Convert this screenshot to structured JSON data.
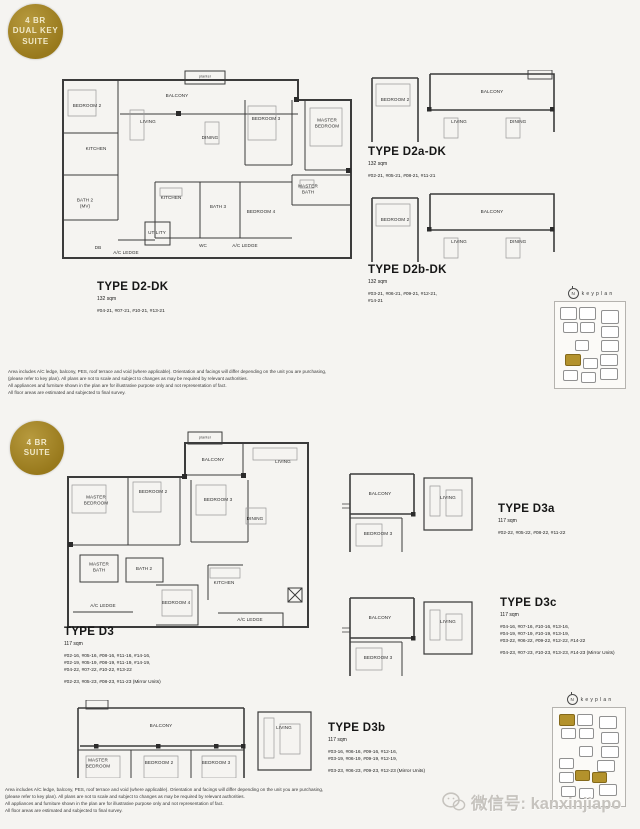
{
  "badges": {
    "dual_key": {
      "line1": "4 BR",
      "line2": "DUAL KEY",
      "line3": "SUITE"
    },
    "suite": {
      "line1": "4 BR",
      "line2": "SUITE"
    }
  },
  "colors": {
    "badge_gold": "#a6871f",
    "keyplan_highlight": "#b3922c",
    "wall": "#3b3b3b"
  },
  "keyplan": {
    "label": "keyplan",
    "north": "N"
  },
  "watermark": {
    "icon": "wechat-icon",
    "text": "微信号: kanxinjiapo"
  },
  "disclaimer": {
    "line1": "Area includes A/C ledge, balcony, PES, roof terrace and void (where applicable). Orientation and facings will differ depending on the unit you are purchasing,",
    "line2": "(please refer to key plan). All plans are not to scale and subject to changes as may be required by relevant authorities.",
    "line3": "All appliances and furniture shown in the plan are for illustrative purpose only and not representation of fact.",
    "line4": "All floor areas are estimated and subjected to final survey."
  },
  "plans": {
    "d2dk": {
      "title": "TYPE D2-DK",
      "area": "132 sqm",
      "units": [
        "#04-21, #07-21, #10-21, #13-21"
      ],
      "rooms": {
        "planter": "planter",
        "balcony": "BALCONY",
        "bedroom2": "BEDROOM 2",
        "living": "LIVING",
        "dining": "DINING",
        "bedroom3": "BEDROOM 3",
        "master_bedroom": "MASTER BEDROOM",
        "kitchen1": "KITCHEN",
        "bath2": "BATH 2 (MV)",
        "kitchen2": "KITCHEN",
        "bath3": "BATH 3",
        "bedroom4": "BEDROOM 4",
        "master_bath": "MASTER BATH",
        "utility": "UTILITY",
        "db": "DB",
        "ac_ledge1": "A/C LEDGE",
        "wc": "WC",
        "ac_ledge2": "A/C LEDGE"
      }
    },
    "d2adk": {
      "title": "TYPE D2a-DK",
      "area": "132 sqm",
      "units": [
        "#02-21, #05-21, #08-21, #11-21"
      ],
      "rooms": {
        "bedroom2": "BEDROOM 2",
        "balcony": "BALCONY",
        "living": "LIVING",
        "dining": "DINING"
      }
    },
    "d2bdk": {
      "title": "TYPE D2b-DK",
      "area": "132 sqm",
      "units": [
        "#03-21, #06-21, #09-21, #12-21,",
        "#14-21"
      ],
      "rooms": {
        "bedroom2": "BEDROOM 2",
        "balcony": "BALCONY",
        "living": "LIVING",
        "dining": "DINING"
      }
    },
    "d3": {
      "title": "TYPE D3",
      "area": "117 sqm",
      "units": [
        "#02-16, #05-16, #08-16, #11-16, #14-16,",
        "#02-19, #05-19, #08-19, #11-19, #14-19,",
        "#04-22, #07-22, #10-22, #13-22"
      ],
      "mirror": "#02-23, #05-23, #08-23, #11-23  (Mirror Units)",
      "rooms": {
        "planter": "planter",
        "balcony": "BALCONY",
        "living": "LIVING",
        "master_bedroom": "MASTER BEDROOM",
        "bedroom2": "BEDROOM 2",
        "bedroom3": "BEDROOM 3",
        "dining": "DINING",
        "master_bath": "MASTER BATH",
        "bath2": "BATH 2",
        "bedroom4": "BEDROOM 4",
        "kitchen": "KITCHEN",
        "ac_ledge1": "A/C LEDGE",
        "ac_ledge2": "A/C LEDGE"
      }
    },
    "d3a": {
      "title": "TYPE D3a",
      "area": "117 sqm",
      "units": [
        "#02-22, #05-22, #08-22, #11-22"
      ],
      "rooms": {
        "balcony": "BALCONY",
        "living": "LIVING",
        "bedroom3": "BEDROOM 3"
      }
    },
    "d3c": {
      "title": "TYPE D3c",
      "area": "117 sqm",
      "units": [
        "#04-16, #07-16, #10-16, #13-16,",
        "#04-19, #07-19, #10-19, #13-19,",
        "#03-22, #06-22, #09-22, #12-22, #14-22"
      ],
      "mirror": "#04-23, #07-23, #10-23, #13-23, #14-23  (Mirror Units)",
      "rooms": {
        "balcony": "BALCONY",
        "living": "LIVING",
        "bedroom3": "BEDROOM 3"
      }
    },
    "d3b": {
      "title": "TYPE D3b",
      "area": "117 sqm",
      "units": [
        "#03-16, #06-16, #09-16, #12-16,",
        "#03-19, #06-19, #09-19, #12-19,"
      ],
      "mirror": "#03-23, #06-23, #09-23, #12-23  (Mirror Units)",
      "rooms": {
        "balcony": "BALCONY",
        "master_bedroom": "MASTER BEDROOM",
        "bedroom2": "BEDROOM 2",
        "bedroom3": "BEDROOM 3",
        "living": "LIVING"
      }
    }
  }
}
